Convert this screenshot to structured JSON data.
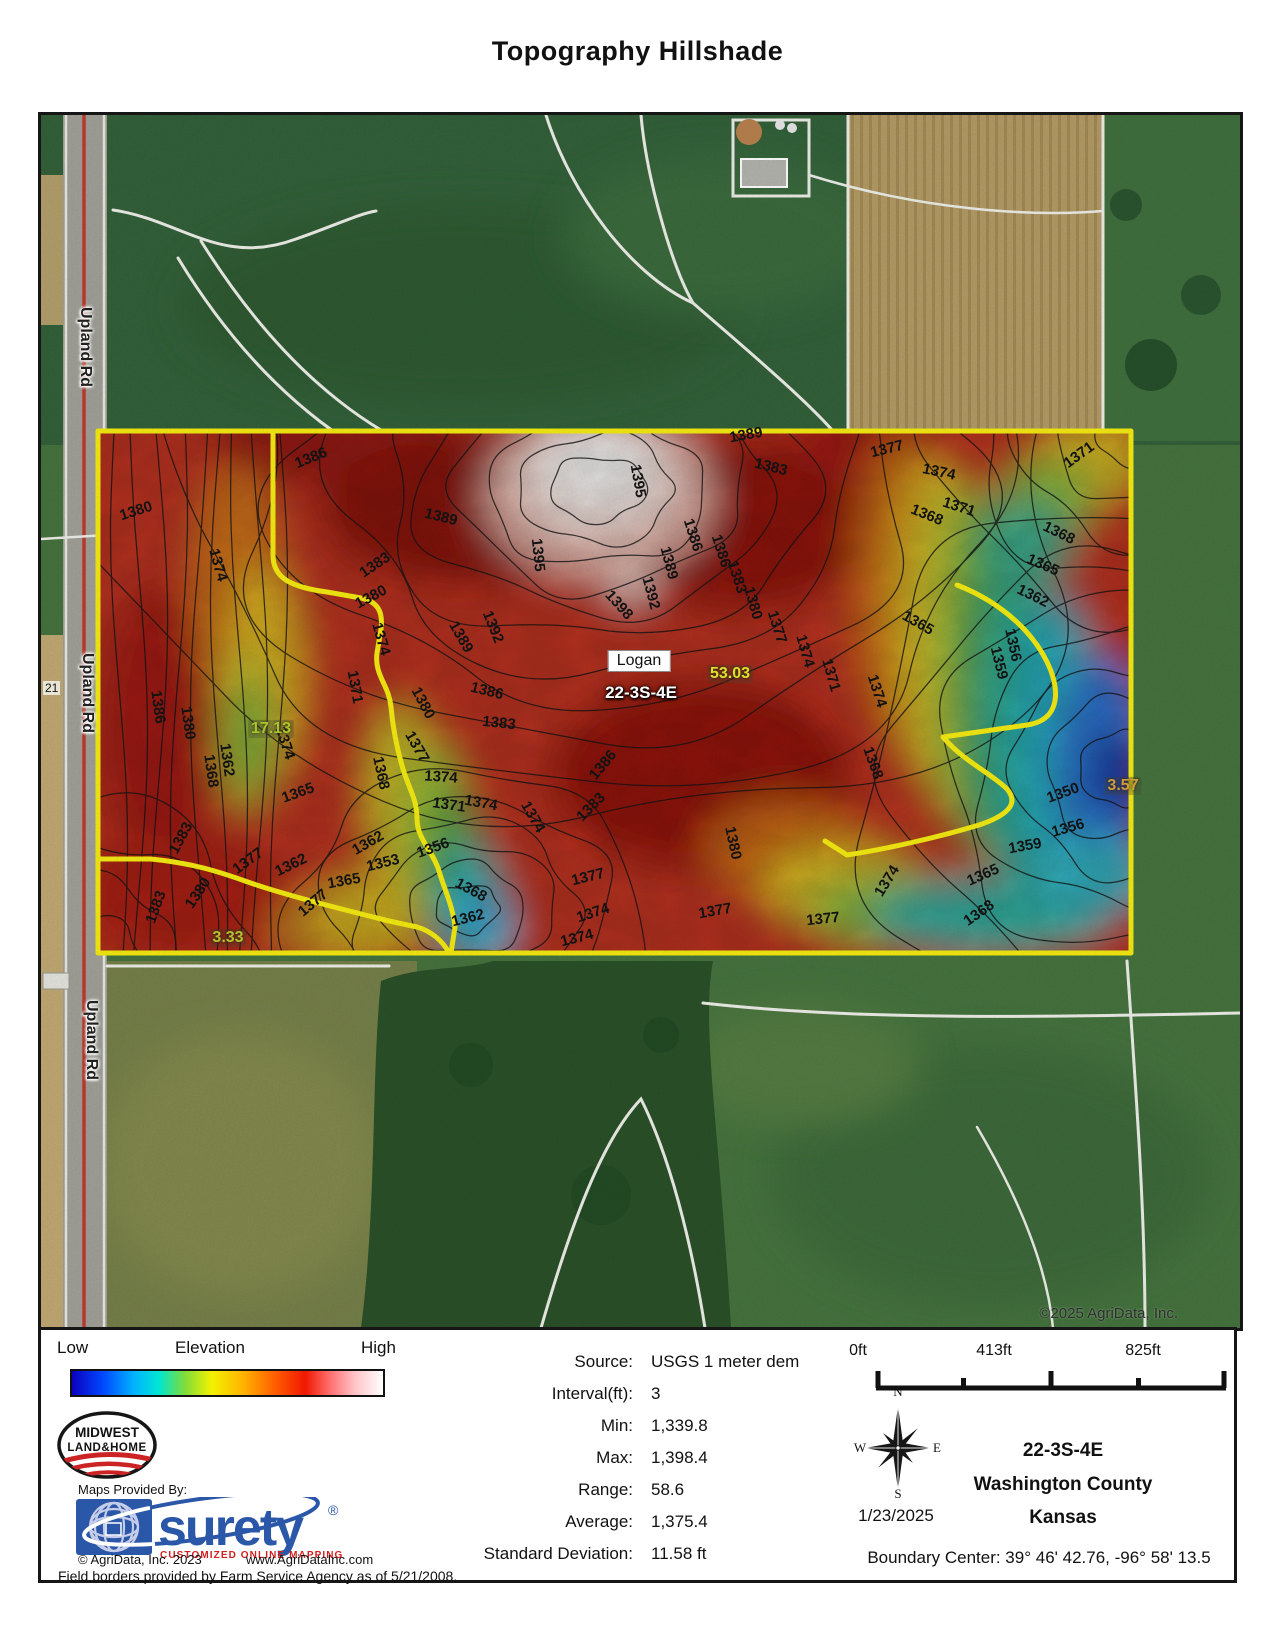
{
  "title": "Topography Hillshade",
  "map": {
    "copyright": "©2025 AgriData, Inc.",
    "road_number": "21",
    "road_labels": [
      {
        "text": "Upland Rd",
        "x": 44,
        "y": 232
      },
      {
        "text": "Upland Rd",
        "x": 46,
        "y": 578
      },
      {
        "text": "Upland Rd",
        "x": 50,
        "y": 925
      }
    ],
    "place_label": "Logan",
    "section_label": "22-3S-4E",
    "acreage_labels": [
      {
        "text": "17.13",
        "x": 230,
        "y": 614,
        "color": "#a9c42c"
      },
      {
        "text": "53.03",
        "x": 689,
        "y": 559,
        "color": "#d8e42c"
      },
      {
        "text": "3.57",
        "x": 1082,
        "y": 671,
        "color": "#d09a40"
      },
      {
        "text": "3.33",
        "x": 187,
        "y": 823,
        "color": "#b4c22e"
      }
    ],
    "contour_labels": [
      {
        "t": "1380",
        "x": 95,
        "y": 396,
        "r": -18
      },
      {
        "t": "1386",
        "x": 270,
        "y": 343,
        "r": -22
      },
      {
        "t": "1389",
        "x": 400,
        "y": 402,
        "r": 14
      },
      {
        "t": "1395",
        "x": 597,
        "y": 366,
        "r": 80
      },
      {
        "t": "1389",
        "x": 705,
        "y": 320,
        "r": -10
      },
      {
        "t": "1383",
        "x": 730,
        "y": 352,
        "r": 14
      },
      {
        "t": "1386",
        "x": 652,
        "y": 420,
        "r": 72
      },
      {
        "t": "1389",
        "x": 628,
        "y": 448,
        "r": 75
      },
      {
        "t": "1392",
        "x": 610,
        "y": 478,
        "r": 75
      },
      {
        "t": "1377",
        "x": 846,
        "y": 334,
        "r": -14
      },
      {
        "t": "1374",
        "x": 898,
        "y": 357,
        "r": 12
      },
      {
        "t": "1371",
        "x": 918,
        "y": 392,
        "r": 18
      },
      {
        "t": "1371",
        "x": 1038,
        "y": 340,
        "r": -36
      },
      {
        "t": "1368",
        "x": 886,
        "y": 400,
        "r": 22
      },
      {
        "t": "1368",
        "x": 1018,
        "y": 418,
        "r": 26
      },
      {
        "t": "1365",
        "x": 1002,
        "y": 450,
        "r": 24
      },
      {
        "t": "1362",
        "x": 992,
        "y": 481,
        "r": 26
      },
      {
        "t": "1374",
        "x": 177,
        "y": 450,
        "r": 74
      },
      {
        "t": "1383",
        "x": 334,
        "y": 450,
        "r": -34
      },
      {
        "t": "1380",
        "x": 330,
        "y": 482,
        "r": -28
      },
      {
        "t": "1395",
        "x": 497,
        "y": 440,
        "r": 84
      },
      {
        "t": "1398",
        "x": 578,
        "y": 490,
        "r": 48
      },
      {
        "t": "1392",
        "x": 452,
        "y": 512,
        "r": 68
      },
      {
        "t": "1389",
        "x": 420,
        "y": 522,
        "r": 60
      },
      {
        "t": "1386",
        "x": 446,
        "y": 576,
        "r": 14
      },
      {
        "t": "1383",
        "x": 458,
        "y": 608,
        "r": 6
      },
      {
        "t": "1386",
        "x": 680,
        "y": 436,
        "r": 72
      },
      {
        "t": "1383",
        "x": 696,
        "y": 462,
        "r": 72
      },
      {
        "t": "1380",
        "x": 712,
        "y": 488,
        "r": 74
      },
      {
        "t": "1377",
        "x": 736,
        "y": 512,
        "r": 72
      },
      {
        "t": "1374",
        "x": 764,
        "y": 536,
        "r": 74
      },
      {
        "t": "1371",
        "x": 790,
        "y": 560,
        "r": 74
      },
      {
        "t": "1368",
        "x": 832,
        "y": 648,
        "r": 70
      },
      {
        "t": "1374",
        "x": 836,
        "y": 576,
        "r": 72
      },
      {
        "t": "1365",
        "x": 877,
        "y": 508,
        "r": 30
      },
      {
        "t": "1356",
        "x": 972,
        "y": 530,
        "r": 78
      },
      {
        "t": "1359",
        "x": 958,
        "y": 548,
        "r": 76
      },
      {
        "t": "1380",
        "x": 382,
        "y": 588,
        "r": 62
      },
      {
        "t": "1377",
        "x": 376,
        "y": 632,
        "r": 60
      },
      {
        "t": "1374",
        "x": 244,
        "y": 628,
        "r": 72
      },
      {
        "t": "1371",
        "x": 314,
        "y": 572,
        "r": 80
      },
      {
        "t": "1374",
        "x": 340,
        "y": 524,
        "r": 74
      },
      {
        "t": "1386",
        "x": 117,
        "y": 592,
        "r": 82
      },
      {
        "t": "1380",
        "x": 147,
        "y": 608,
        "r": 82
      },
      {
        "t": "1368",
        "x": 170,
        "y": 656,
        "r": 82
      },
      {
        "t": "1362",
        "x": 186,
        "y": 645,
        "r": 82
      },
      {
        "t": "1365",
        "x": 257,
        "y": 678,
        "r": -20
      },
      {
        "t": "1374",
        "x": 400,
        "y": 662,
        "r": 4
      },
      {
        "t": "1371",
        "x": 408,
        "y": 690,
        "r": 8
      },
      {
        "t": "1368",
        "x": 340,
        "y": 658,
        "r": 78
      },
      {
        "t": "1362",
        "x": 327,
        "y": 728,
        "r": -30
      },
      {
        "t": "1353",
        "x": 342,
        "y": 748,
        "r": -14
      },
      {
        "t": "1356",
        "x": 392,
        "y": 733,
        "r": -20
      },
      {
        "t": "1374",
        "x": 492,
        "y": 702,
        "r": 60
      },
      {
        "t": "1374",
        "x": 440,
        "y": 688,
        "r": 10
      },
      {
        "t": "1386",
        "x": 562,
        "y": 650,
        "r": -50
      },
      {
        "t": "1383",
        "x": 550,
        "y": 692,
        "r": -45
      },
      {
        "t": "1380",
        "x": 692,
        "y": 728,
        "r": 78
      },
      {
        "t": "1350",
        "x": 1022,
        "y": 678,
        "r": -20
      },
      {
        "t": "1356",
        "x": 1027,
        "y": 713,
        "r": -16
      },
      {
        "t": "1359",
        "x": 984,
        "y": 731,
        "r": -10
      },
      {
        "t": "1365",
        "x": 942,
        "y": 760,
        "r": -24
      },
      {
        "t": "1368",
        "x": 938,
        "y": 798,
        "r": -35
      },
      {
        "t": "1374",
        "x": 846,
        "y": 766,
        "r": -58
      },
      {
        "t": "1377",
        "x": 782,
        "y": 804,
        "r": -6
      },
      {
        "t": "1377",
        "x": 674,
        "y": 796,
        "r": -10
      },
      {
        "t": "1374",
        "x": 552,
        "y": 798,
        "r": -18
      },
      {
        "t": "1377",
        "x": 547,
        "y": 762,
        "r": -14
      },
      {
        "t": "1374",
        "x": 536,
        "y": 823,
        "r": -14
      },
      {
        "t": "1362",
        "x": 427,
        "y": 803,
        "r": -14
      },
      {
        "t": "1368",
        "x": 430,
        "y": 775,
        "r": 28
      },
      {
        "t": "1365",
        "x": 303,
        "y": 766,
        "r": -10
      },
      {
        "t": "1362",
        "x": 250,
        "y": 750,
        "r": -26
      },
      {
        "t": "1377",
        "x": 207,
        "y": 746,
        "r": -36
      },
      {
        "t": "1380",
        "x": 157,
        "y": 778,
        "r": -56
      },
      {
        "t": "1383",
        "x": 115,
        "y": 792,
        "r": -70
      },
      {
        "t": "1383",
        "x": 140,
        "y": 723,
        "r": -62
      },
      {
        "t": "1377",
        "x": 272,
        "y": 788,
        "r": -40
      }
    ]
  },
  "legend": {
    "low": "Low",
    "mid": "Elevation",
    "high": "High"
  },
  "branding": {
    "midwest_line1": "MIDWEST",
    "midwest_line2": "LAND&HOME",
    "maps_provided": "Maps Provided By:",
    "surety": "surety",
    "surety_reg": "®",
    "surety_tag": "CUSTOMIZED ONLINE MAPPING",
    "agridata_copy": "© AgriData, Inc. 2023",
    "agridata_url": "www.AgriDataInc.com",
    "field_note": "Field borders provided by Farm Service Agency as of 5/21/2008."
  },
  "stats": {
    "rows": [
      {
        "label": "Source:",
        "value": "USGS 1 meter dem"
      },
      {
        "label": "Interval(ft):",
        "value": "3"
      },
      {
        "label": "Min:",
        "value": "1,339.8"
      },
      {
        "label": "Max:",
        "value": "1,398.4"
      },
      {
        "label": "Range:",
        "value": "58.6"
      },
      {
        "label": "Average:",
        "value": "1,375.4"
      },
      {
        "label": "Standard Deviation:",
        "value": "11.58 ft"
      }
    ]
  },
  "scalebar": {
    "labels": [
      "0ft",
      "413ft",
      "825ft"
    ]
  },
  "compass": {
    "n": "N",
    "e": "E",
    "s": "S",
    "w": "W",
    "date": "1/23/2025"
  },
  "location": {
    "section": "22-3S-4E",
    "county": "Washington County",
    "state": "Kansas",
    "boundary": "Boundary Center: 39° 46' 42.76,  -96° 58' 13.5"
  }
}
